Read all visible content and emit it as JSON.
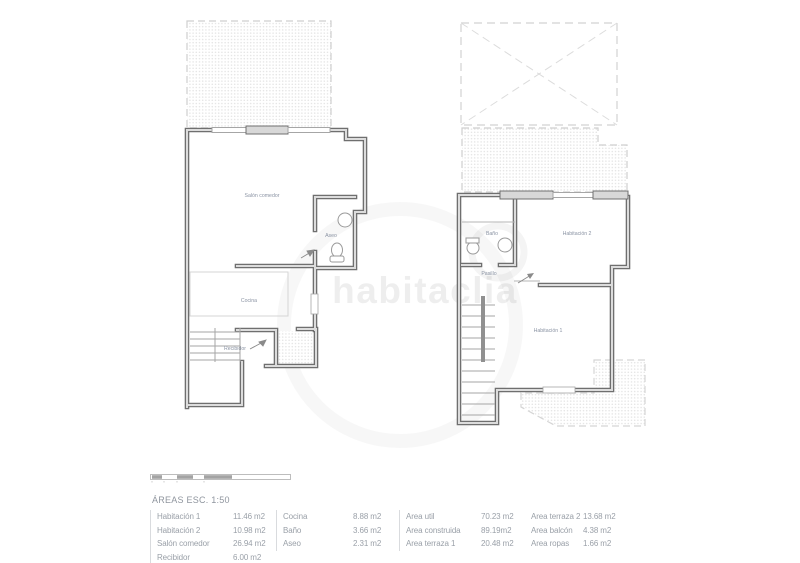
{
  "watermark": {
    "text": "habitaclia"
  },
  "plans": {
    "left": {
      "rooms": [
        {
          "label": "Salón comedor"
        },
        {
          "label": "Aseo"
        },
        {
          "label": "Cocina"
        },
        {
          "label": "Recibidor"
        }
      ]
    },
    "right": {
      "rooms": [
        {
          "label": "Baño"
        },
        {
          "label": "Habitación 2"
        },
        {
          "label": "Pasillo"
        },
        {
          "label": "Habitación 1"
        }
      ]
    }
  },
  "legend": {
    "title": "ÁREAS ESC. 1:50",
    "groups": [
      {
        "rows": [
          {
            "label": "Habitación 1",
            "value": "11.46 m2"
          },
          {
            "label": "Habitación 2",
            "value": "10.98 m2"
          },
          {
            "label": "Salón comedor",
            "value": "26.94 m2"
          },
          {
            "label": "Recibidor",
            "value": "6.00 m2"
          }
        ]
      },
      {
        "rows": [
          {
            "label": "Cocina",
            "value": "8.88 m2"
          },
          {
            "label": "Baño",
            "value": "3.66 m2"
          },
          {
            "label": "Aseo",
            "value": "2.31 m2"
          }
        ]
      },
      {
        "rows": [
          {
            "label": "Area util",
            "value": "70.23 m2"
          },
          {
            "label": "Area construida",
            "value": "89.19m2"
          },
          {
            "label": "Area terraza 1",
            "value": "20.48 m2"
          }
        ]
      },
      {
        "rows": [
          {
            "label": "Area terraza 2",
            "value": "13.68 m2"
          },
          {
            "label": "Area balcón",
            "value": "4.38 m2"
          },
          {
            "label": "Area ropas",
            "value": "1.66 m2"
          }
        ]
      }
    ]
  },
  "colors": {
    "wall": "#6f6f6f",
    "wall_fill": "#dcdcdc",
    "sill_fill": "#d8d8d8",
    "thin_line": "#a6a6a6",
    "hatch_dot": "#e3e3e3",
    "dashed_border": "#cfcfcf",
    "room_label": "#8a93a3",
    "legend_text": "#9aa0a8",
    "divider": "#d9dbde"
  }
}
